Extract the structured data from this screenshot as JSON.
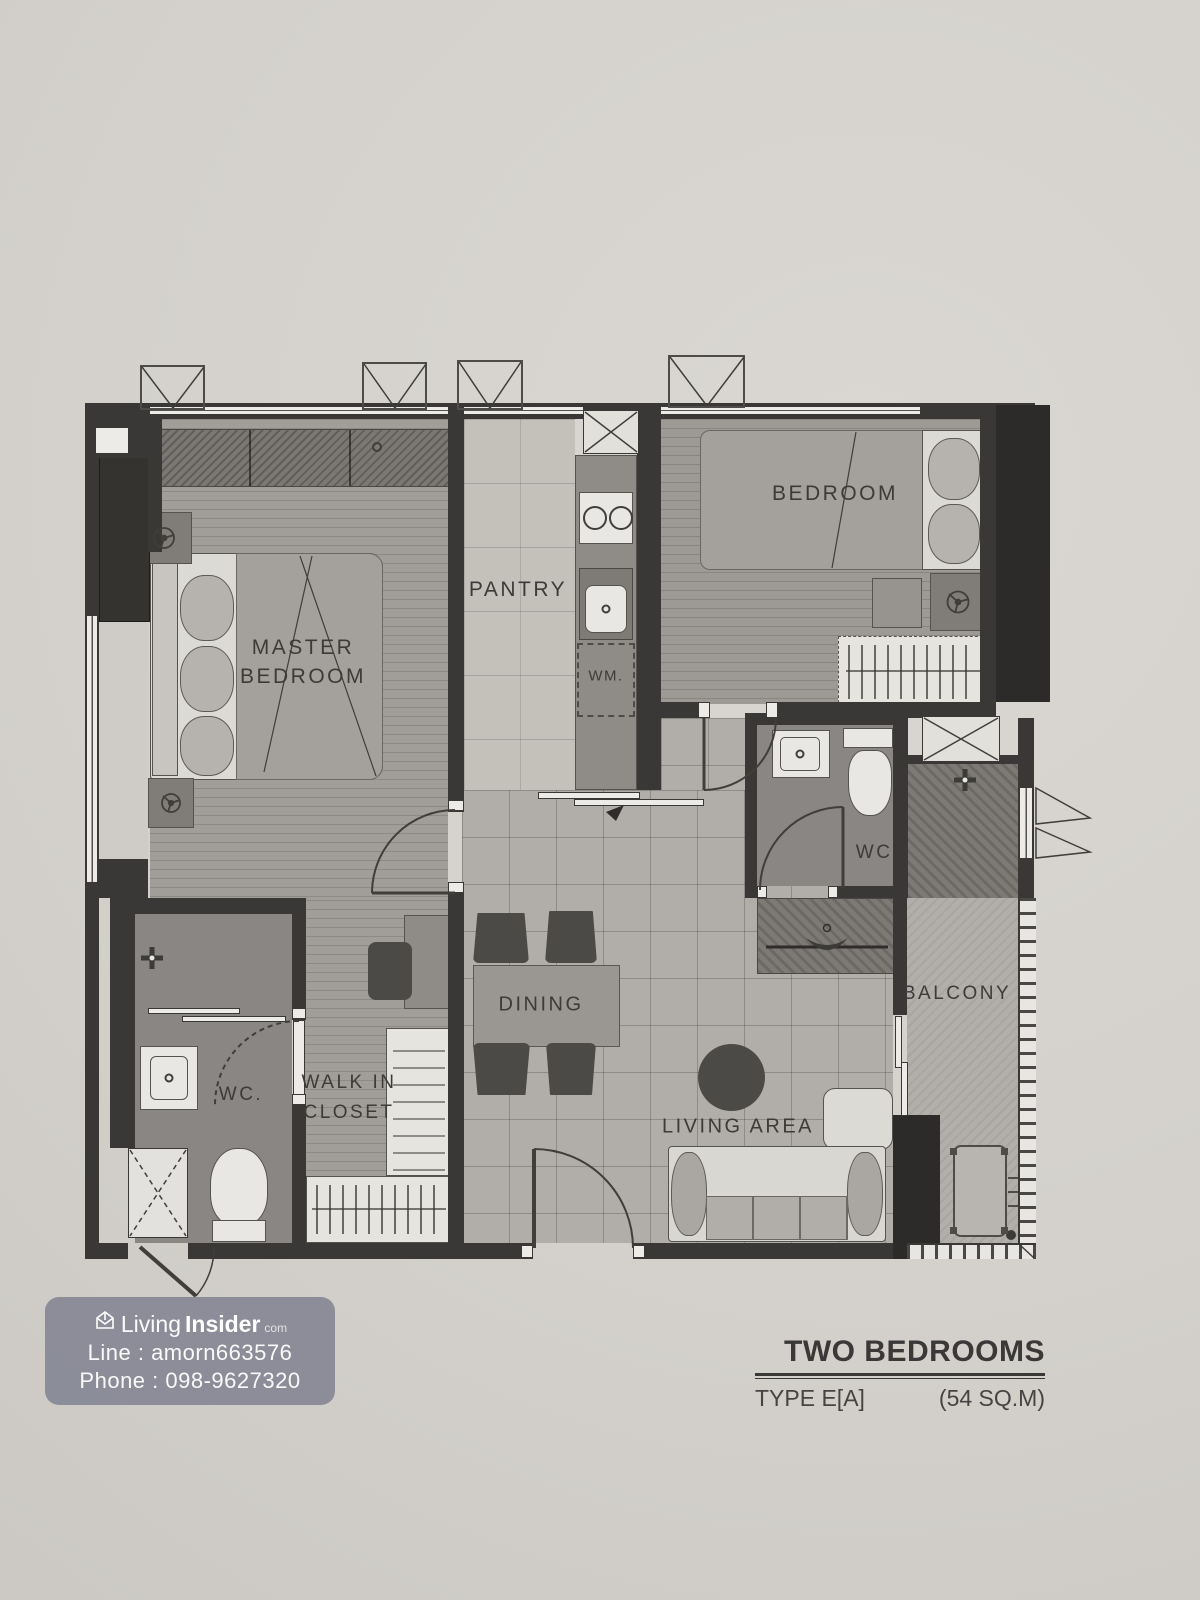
{
  "palette": {
    "paper": "#d4d1cc",
    "wall": "#3a3836",
    "grid_floor": "#b1aea9",
    "stripe_floor": "#a19e99",
    "pantry_floor": "#c4c1bb",
    "wc_floor": "#898683",
    "balcony_floor": "#b2afaa",
    "dark_furniture": "#4c4a47",
    "fixture_white": "#e9e7e3",
    "watermark_bg": "#7d7f8e",
    "label_text": "#3c3b38"
  },
  "plan": {
    "rooms": {
      "master_bedroom": {
        "line1": "MASTER",
        "line2": "BEDROOM"
      },
      "bedroom": {
        "label": "BEDROOM"
      },
      "pantry": {
        "label": "PANTRY"
      },
      "dining": {
        "label": "DINING"
      },
      "living_area": {
        "label": "LIVING AREA"
      },
      "balcony": {
        "label": "BALCONY"
      },
      "walk_in_closet": {
        "line1": "WALK IN",
        "line2": "CLOSET"
      },
      "wc_master": {
        "label": "WC."
      },
      "wc_common": {
        "label": "WC."
      }
    },
    "fixtures": {
      "washing_machine": "WM."
    }
  },
  "watermark": {
    "brand_first": "Living",
    "brand_second": "Insider",
    "brand_tld": "com",
    "line_contact": "Line : amorn663576",
    "phone_contact": "Phone : 098-9627320"
  },
  "title_block": {
    "plan_name": "TWO BEDROOMS",
    "unit_type": "TYPE E[A]",
    "unit_area": "(54 SQ.M)"
  }
}
